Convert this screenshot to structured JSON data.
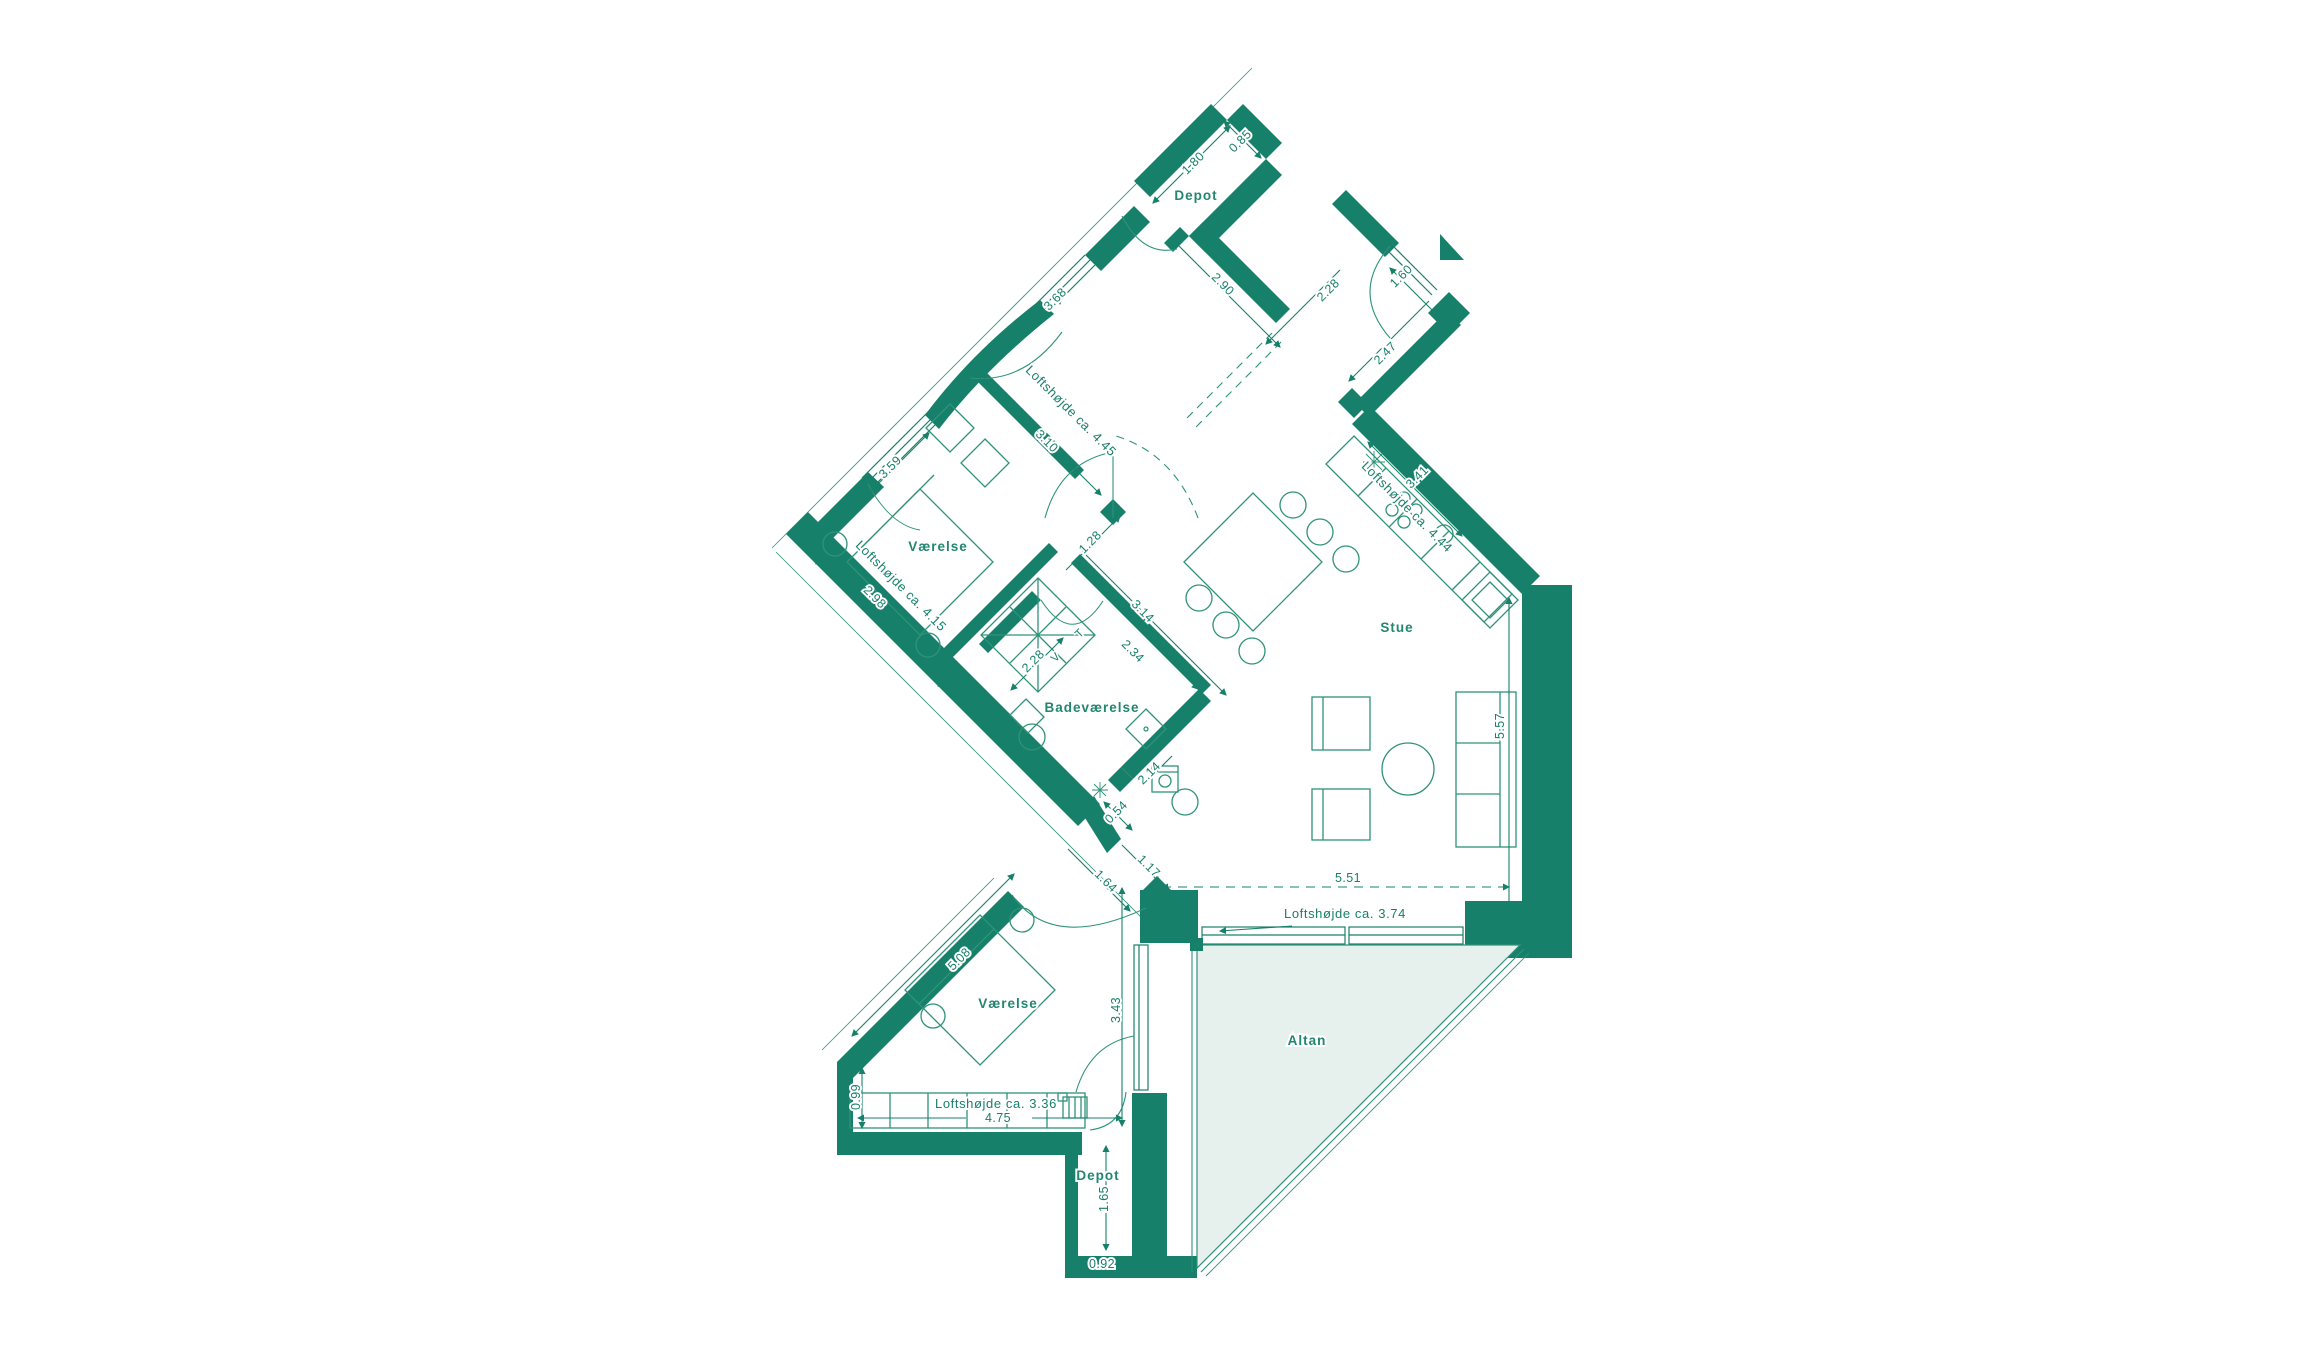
{
  "colors": {
    "wall_green": "#17806A",
    "line_green": "#2E9379",
    "balcony_fill": "#E6F1EE",
    "background": "#FFFFFF"
  },
  "rooms": {
    "depot_top": "Depot",
    "vaerelse_upper": "Værelse",
    "badevaerelse": "Badeværelse",
    "stue": "Stue",
    "vaerelse_lower": "Værelse",
    "depot_bottom": "Depot",
    "altan": "Altan"
  },
  "ceiling_heights": {
    "entre": "Loftshøjde ca. 4.45",
    "vaerelse_upper": "Loftshøjde ca. 4.15",
    "kitchen": "Loftshøjde ca. 4.44",
    "stue": "Loftshøjde ca. 3.74",
    "vaerelse_lower": "Loftshøjde ca. 3.36"
  },
  "dimensions": {
    "depot_top_length": "1.80",
    "depot_top_width": "0.85",
    "entre_length": "2.90",
    "entre_width": "3.68",
    "stue_north_notch": "2.28",
    "stue_entry_door": "1.60",
    "stue_northeast_wall": "2.47",
    "vaerelse_upper_width": "3.59",
    "vaerelse_upper_depth": "3.10",
    "vaerelse_upper_southwest": "2.98",
    "bath_hall_door": "1.28",
    "bath_outer_wall": "3.14",
    "bath_inner_wall": "2.34",
    "bath_hall_length": "2.28",
    "washer_niche_depth": "2.14",
    "washer_niche_width": "0.54",
    "kitchen_counter": "3.41",
    "stue_east_wall": "5.57",
    "stue_south_wall": "5.51",
    "hall_opening": "1.17",
    "vaerelse_lower_door": "1.64",
    "vaerelse_lower_facade": "5.08",
    "vaerelse_lower_depth": "3.43",
    "vaerelse_lower_west": "0.99",
    "vaerelse_lower_width": "4.75",
    "depot_bottom_depth": "1.65",
    "depot_bottom_width": "0.92"
  },
  "appliance_marks": {
    "washer": "V",
    "dryer": "T"
  }
}
